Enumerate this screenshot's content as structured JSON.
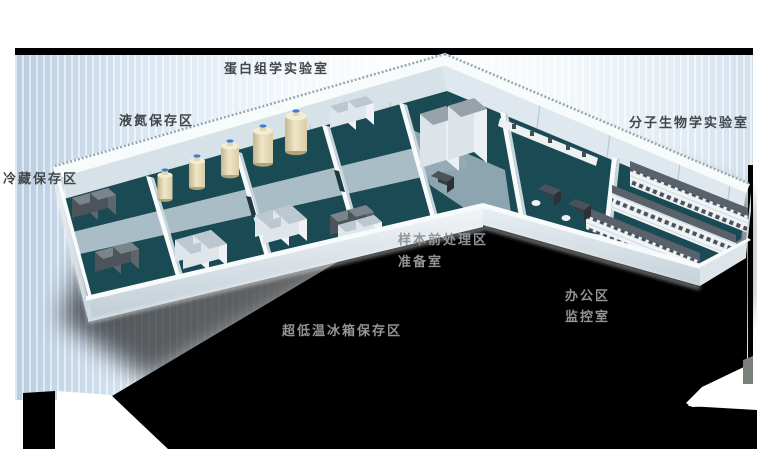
{
  "labels": {
    "protein_lab": "蛋白组学实验室",
    "ln2_storage": "液氮保存区",
    "cold_storage": "冷藏保存区",
    "molecular_lab": "分子生物学实验室",
    "sample_pretreatment": "样本前处理区",
    "prep_room": "准备室",
    "office": "办公区",
    "monitor_room": "监控室",
    "ult_freezer_storage": "超低温冰箱保存区"
  },
  "colors": {
    "floor-teal": "#1a4a53",
    "floor-corridor": "#a9bdc7",
    "floor-light": "#94aab5",
    "wall-inner": "#d6e1e8",
    "wall-white": "#f7fbfc",
    "bg-blue": "#b9cde1",
    "bar-black": "#000000",
    "shadow-black": "#000000",
    "label-dark": "#43474a",
    "label-gray": "#919598",
    "tank-cream": "#e7dcba",
    "tank-cap-blue": "#3c7fd0",
    "freezer-slate": "#4b535b",
    "cabinet-light": "#dfe6eb",
    "bench-slate": "#59616a"
  }
}
